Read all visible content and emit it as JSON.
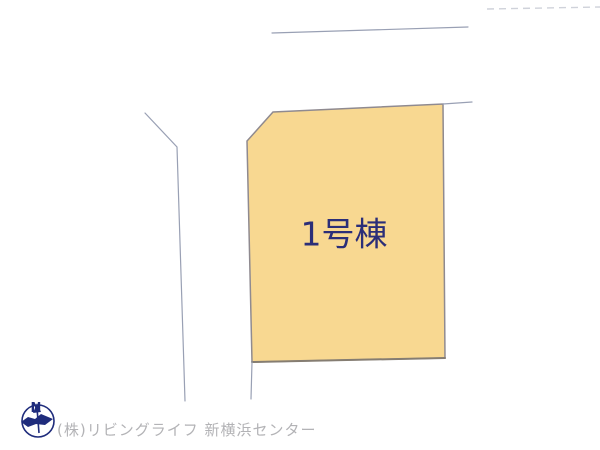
{
  "plan": {
    "lot_label": "1号棟"
  },
  "compass": {
    "north_label": "N"
  },
  "footer": {
    "company_credit": "(株)リビングライフ 新横浜センター"
  },
  "colors": {
    "background": "#FFFFFF",
    "parcel_fill": "#F8D891",
    "parcel_stroke": "#8F8A90",
    "parcel_bottom_shadow": "#857D72",
    "boundary_line": "#99A0B4",
    "faint_line": "#CFD2DA",
    "lot_label_text": "#2B2E78",
    "compass_navy": "#1F2C7C",
    "footer_text": "#B3B3B6"
  }
}
